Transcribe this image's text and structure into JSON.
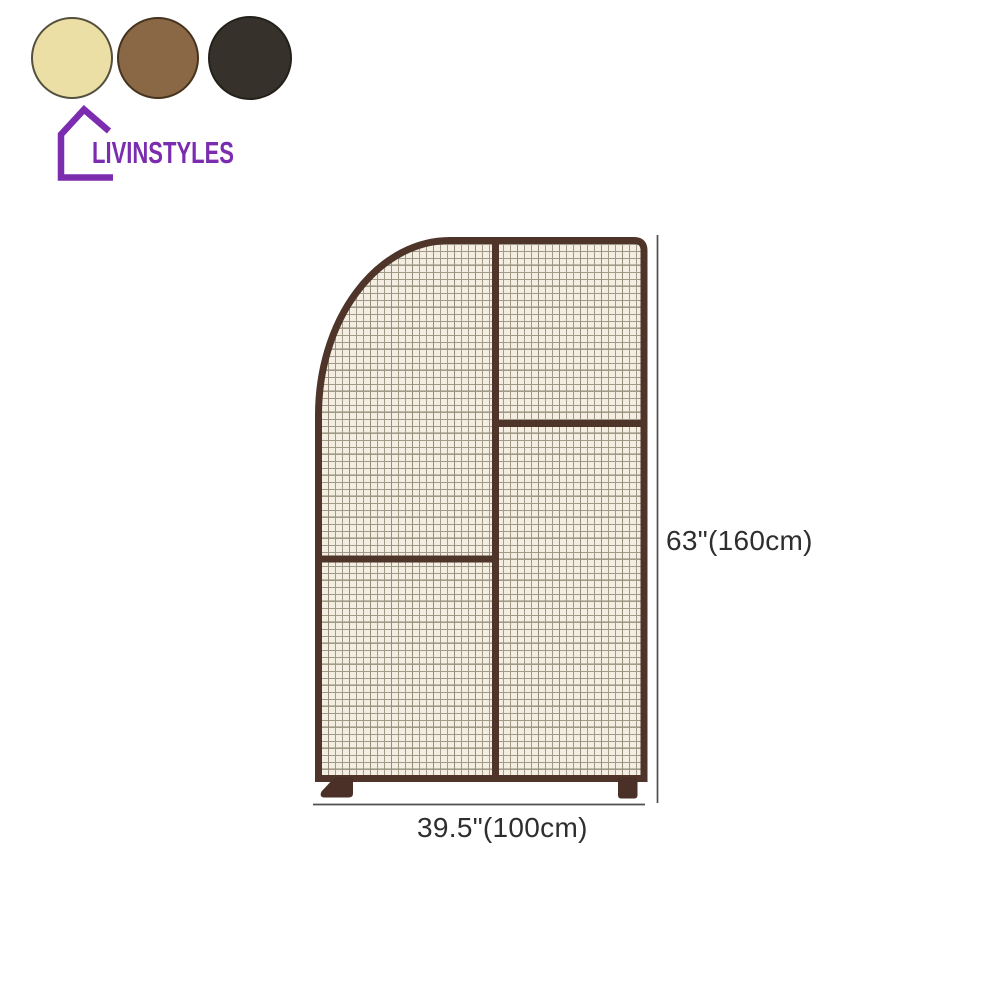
{
  "brand": {
    "name": "LIVINSTYLES",
    "color": "#7b2caf"
  },
  "swatches": {
    "items": [
      {
        "name": "cream",
        "color": "#ebdfa6",
        "border": "#55503e"
      },
      {
        "name": "brown",
        "color": "#8a6845",
        "border": "#46331f"
      },
      {
        "name": "dark-brown",
        "color": "#37312b",
        "border": "#23201b"
      }
    ]
  },
  "product": {
    "name": "mesh screen room divider",
    "frame_color": "#4f342a",
    "foot_color": "#4a3026",
    "mesh_background": "#f3eee1",
    "mesh_line_color": "#a29a88",
    "mesh_line_color_2": "#877e6b",
    "dimension_color": "#4f4f4f",
    "label_color": "#2e2e2e",
    "height_label": "63\"(160cm)",
    "width_label": "39.5\"(100cm)"
  }
}
